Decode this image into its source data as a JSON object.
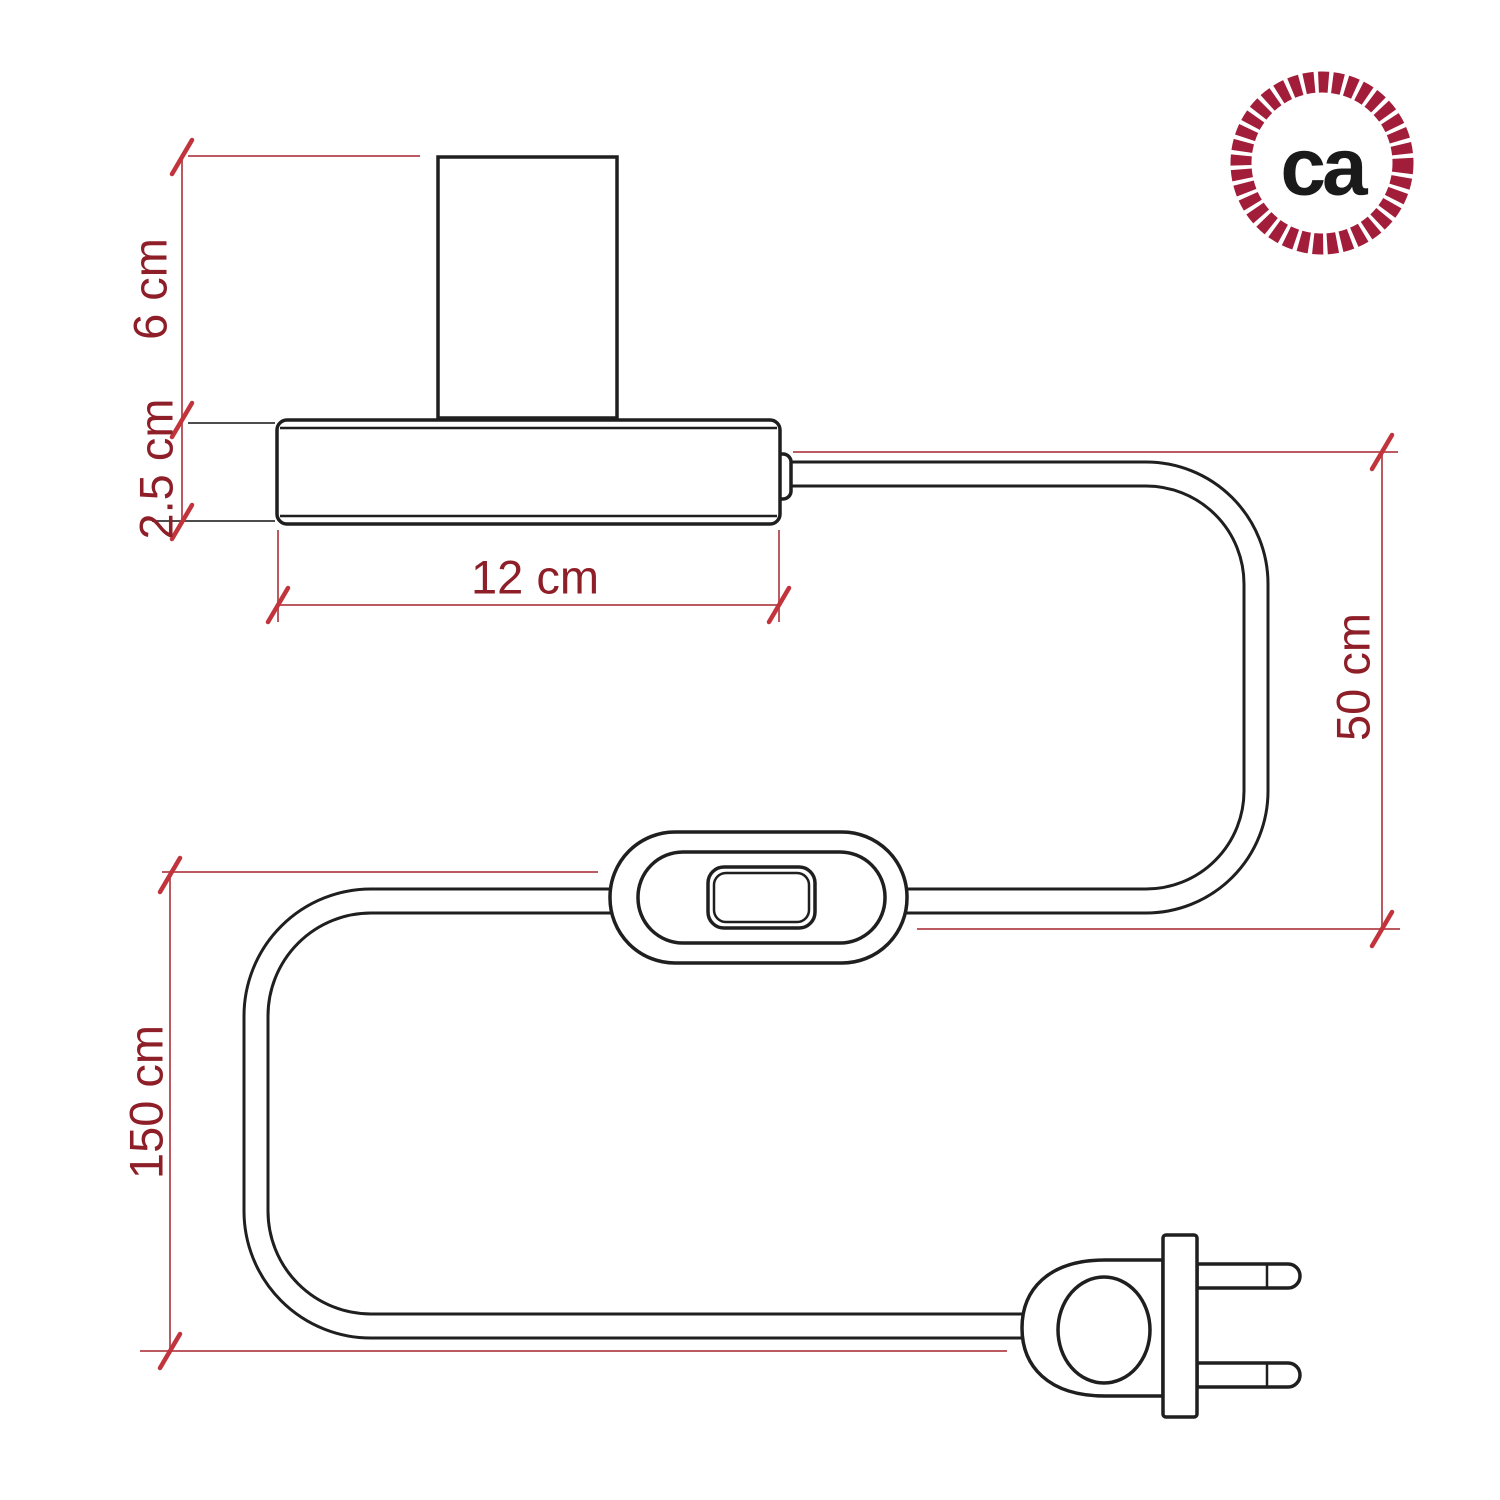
{
  "page": {
    "background_color": "#ffffff",
    "drawing_stroke_color": "#1f1f1f"
  },
  "logo": {
    "text": "ca",
    "rope_ring_color": "#A21D3A",
    "text_color": "#1a1a1a"
  },
  "dimension_style": {
    "line_color": "#bb5a60",
    "tick_color": "#c2343c",
    "label_color": "#8E1F28"
  },
  "dimensions": {
    "socket_height": {
      "label": "6 cm",
      "value_cm": 6
    },
    "base_height": {
      "label": "2.5 cm",
      "value_cm": 2.5
    },
    "base_width": {
      "label": "12 cm",
      "value_cm": 12
    },
    "cable_base_to_switch": {
      "label": "50 cm",
      "value_cm": 50
    },
    "cable_switch_to_plug": {
      "label": "150 cm",
      "value_cm": 150
    }
  }
}
